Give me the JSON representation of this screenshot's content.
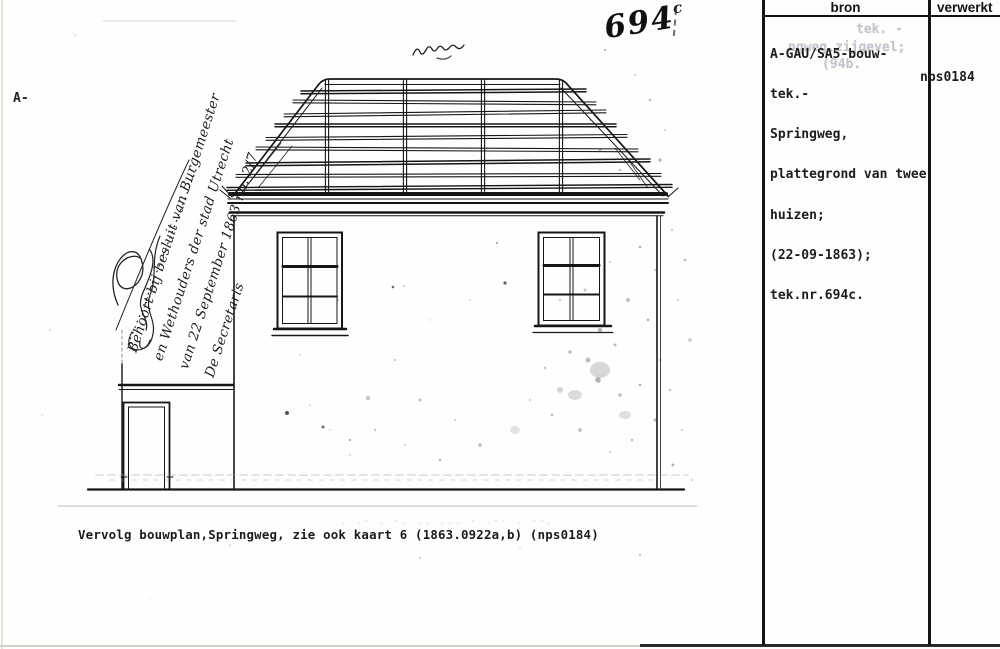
{
  "page": {
    "label": "Gescande archiefkaart bouwtekening Springweg"
  },
  "margin": {
    "corpus_mark": "A-"
  },
  "drawing": {
    "number": "694",
    "number_suffix": "c",
    "handwritten_note_lines": [
      "Behoort bij besluit van Burgemeester",
      "en Wethouders der stad Utrecht",
      "van 22 September 1863 no. 2/7",
      "De Secretaris"
    ]
  },
  "caption": {
    "text": "Vervolg bouwplan,Springweg, zie ook kaart 6 (1863.0922a,b)  (nps0184)"
  },
  "panel": {
    "columns": {
      "bron": "bron",
      "verwerkt": "verwerkt"
    },
    "source_entry": {
      "lines": [
        "A-GAU/SA5-bouw-",
        "tek.-",
        "Springweg,",
        "plattegrond van twee",
        "huizen;",
        "(22-09-1863);",
        "tek.nr.694c."
      ]
    },
    "verwerkt_value": "nps0184",
    "ghost_lines": [
      "tek. -",
      "ngweg,zijgevel;",
      "(94b."
    ]
  },
  "colors": {
    "ink": "#151515",
    "paper": "#ffffff",
    "ghost_text": "#c3c7cd"
  }
}
